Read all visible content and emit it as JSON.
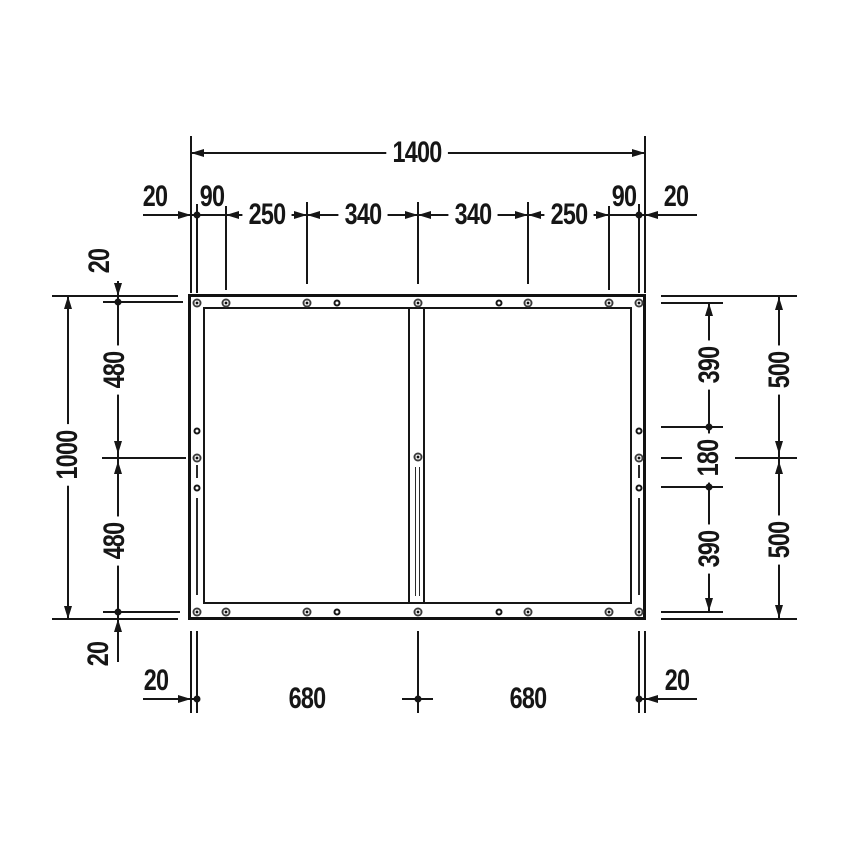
{
  "drawing": {
    "ink_color": "#161616",
    "background_color": "#ffffff"
  },
  "dims": {
    "top": {
      "overall": "1400",
      "offset_left": "20",
      "edge_left": "90",
      "span_250_left": "250",
      "span_340_left": "340",
      "span_340_right": "340",
      "span_250_right": "250",
      "edge_right": "90",
      "offset_right": "20"
    },
    "left": {
      "offset_top": "20",
      "upper": "480",
      "overall": "1000",
      "lower": "480",
      "offset_bottom": "20"
    },
    "right": {
      "upper_inner": "390",
      "upper_outer": "500",
      "middle": "180",
      "lower_inner": "390",
      "lower_outer": "500"
    },
    "bottom": {
      "offset_left": "20",
      "half_left": "680",
      "half_right": "680",
      "offset_right": "20"
    }
  }
}
